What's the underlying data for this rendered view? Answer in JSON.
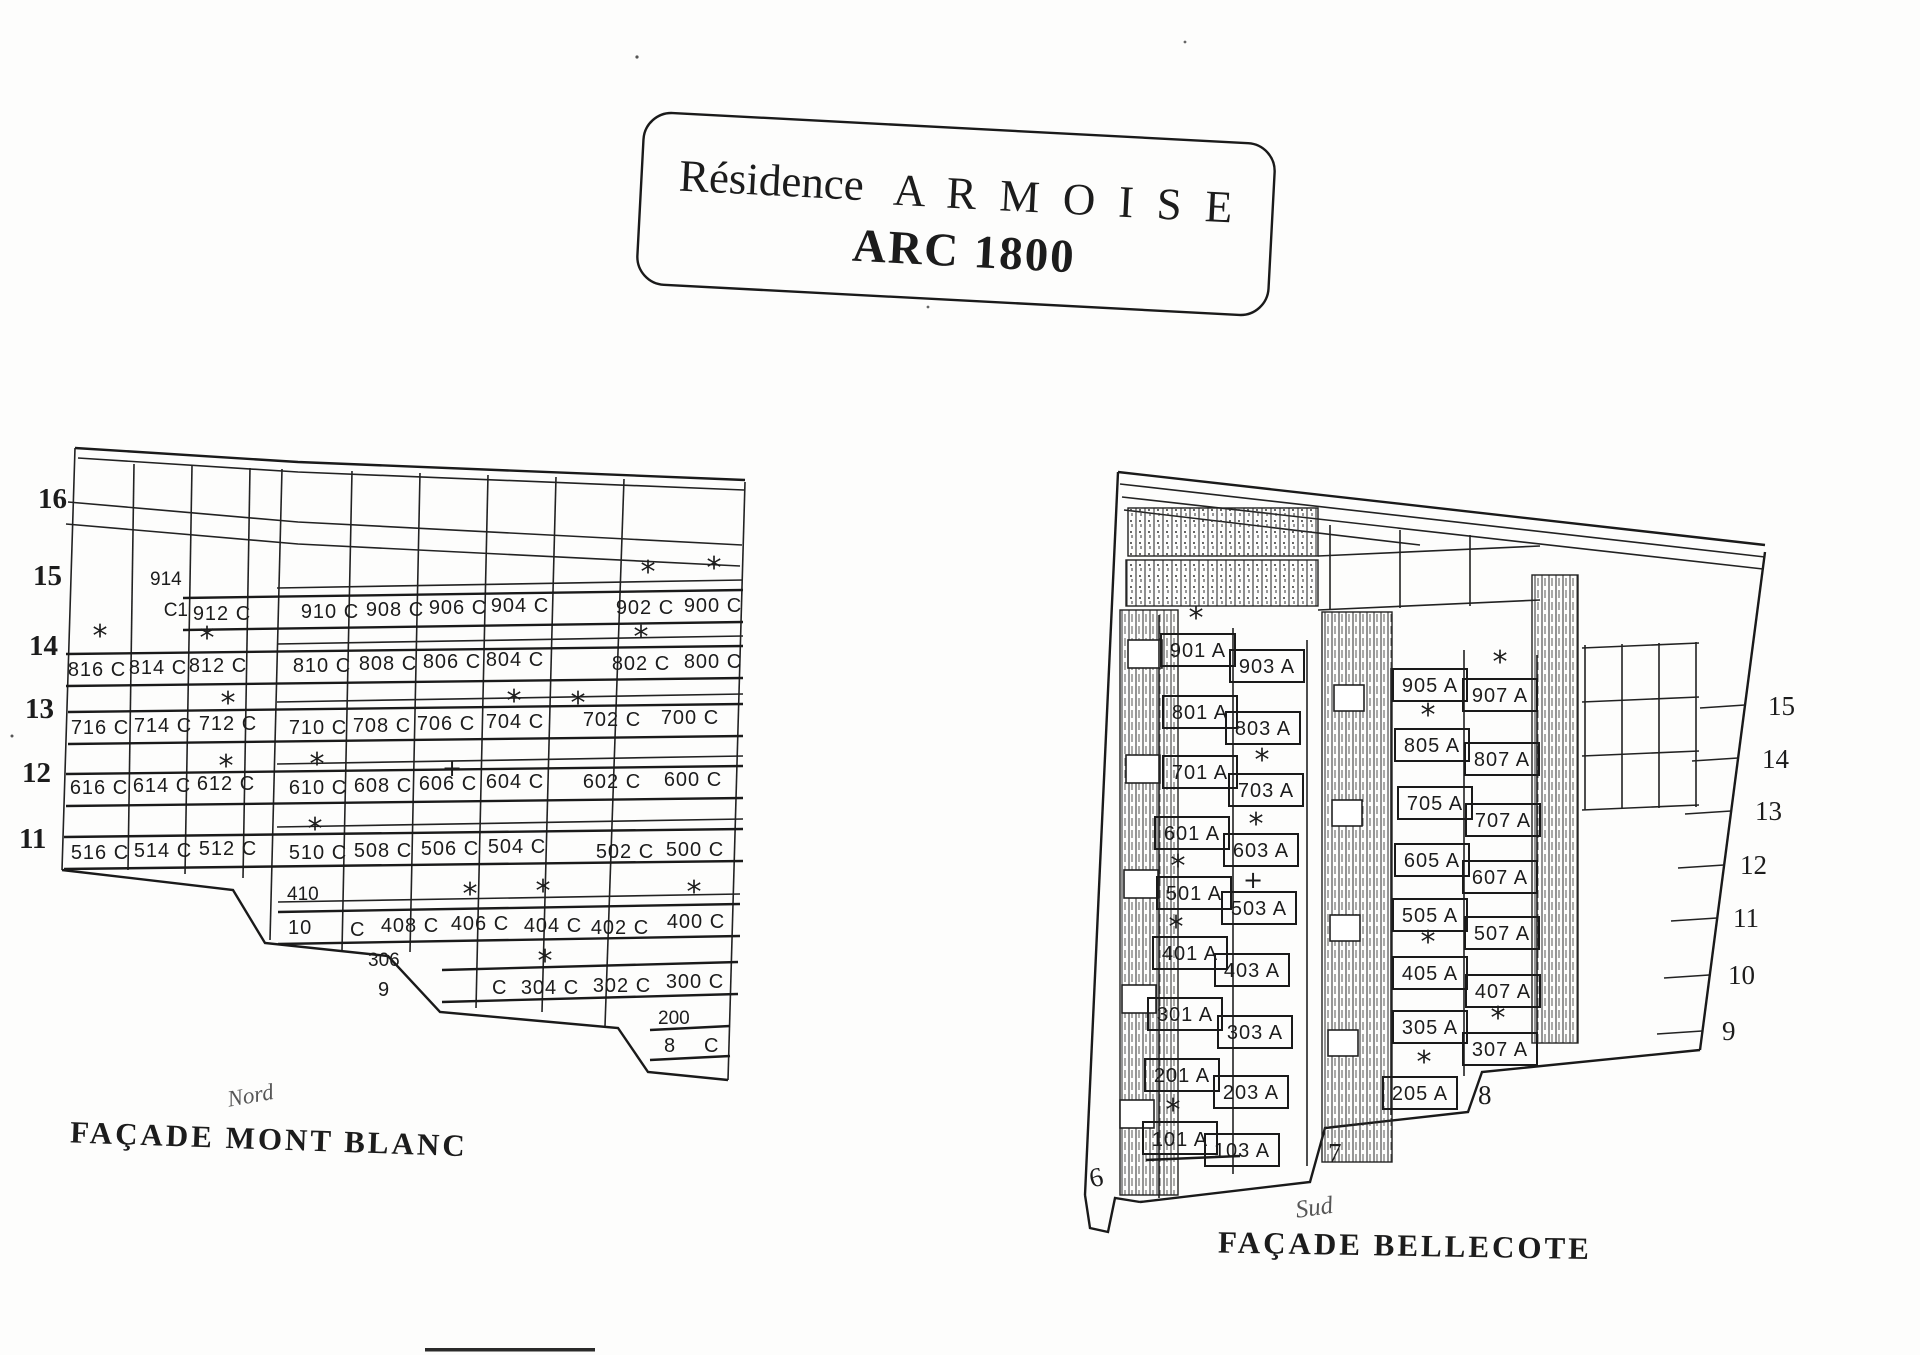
{
  "title": {
    "prefix": "Résidence",
    "name": "A R M O I S E",
    "subtitle": "ARC 1800"
  },
  "symbols": {
    "star": "*",
    "plus": "+"
  },
  "mont_blanc": {
    "caption": "FAÇADE  MONT BLANC",
    "note": "Nord",
    "floors": [
      "16",
      "15",
      "14",
      "13",
      "12",
      "11"
    ],
    "cell_914": "914",
    "cell_c1": "C1",
    "r15": [
      "912 C",
      "910 C",
      "908 C",
      "906 C",
      "904 C",
      "902 C",
      "900 C"
    ],
    "r14": [
      "816 C",
      "814 C",
      "812 C",
      "810 C",
      "808 C",
      "806 C",
      "804 C",
      "802 C",
      "800 C"
    ],
    "r13": [
      "716 C",
      "714 C",
      "712 C",
      "710 C",
      "708 C",
      "706 C",
      "704 C",
      "702 C",
      "700 C"
    ],
    "r12": [
      "616 C",
      "614 C",
      "612 C",
      "610 C",
      "608 C",
      "606 C",
      "604 C",
      "602 C",
      "600 C"
    ],
    "r11": [
      "516 C",
      "514 C",
      "512 C",
      "510 C",
      "508 C",
      "506 C",
      "504 C",
      "502 C",
      "500 C"
    ],
    "r10_apt": "410",
    "r10_floor": "10",
    "r10_c": "C",
    "r10": [
      "408 C",
      "406 C",
      "404 C",
      "402 C",
      "400 C"
    ],
    "r9_apt": "306",
    "r9_floor": "9",
    "r9_c": "C",
    "r9": [
      "304 C",
      "302 C",
      "300 C"
    ],
    "r8_apt": "200",
    "r8_floor": "8",
    "r8_c": "C"
  },
  "bellecote": {
    "caption": "FAÇADE  BELLECOTE",
    "note": "Sud",
    "col1": [
      "901 A",
      "801 A",
      "701 A",
      "601 A",
      "501 A",
      "401 A",
      "301 A",
      "201 A",
      "101 A"
    ],
    "col2": [
      "903 A",
      "803 A",
      "703 A",
      "603 A",
      "503 A",
      "403 A",
      "303 A",
      "203 A",
      "103 A"
    ],
    "col3": [
      "905 A",
      "805 A",
      "705 A",
      "605 A",
      "505 A",
      "405 A",
      "305 A",
      "205 A"
    ],
    "col4": [
      "907 A",
      "807 A",
      "707 A",
      "607 A",
      "507 A",
      "407 A",
      "307 A"
    ],
    "floors_right": [
      "15",
      "14",
      "13",
      "12",
      "11",
      "10",
      "9"
    ],
    "floor8": "8",
    "floor7": "7",
    "floor6": "6"
  }
}
